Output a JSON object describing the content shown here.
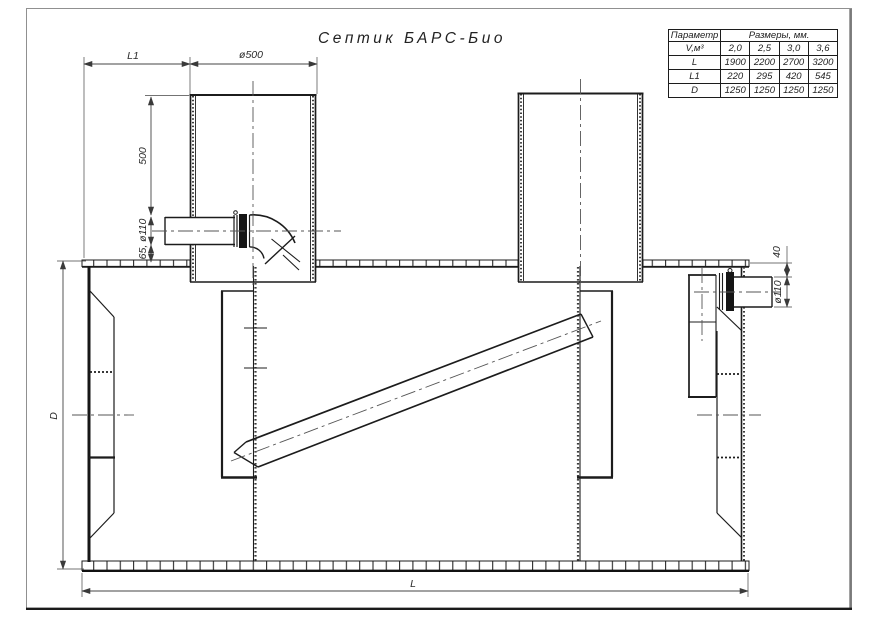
{
  "title": "Септик БАРС-Био",
  "table": {
    "header": {
      "param": "Параметр",
      "sizes": "Размеры, мм."
    },
    "rows": [
      {
        "name": "V,м³",
        "values": [
          "2,0",
          "2,5",
          "3,0",
          "3,6"
        ]
      },
      {
        "name": "L",
        "values": [
          "1900",
          "2200",
          "2700",
          "3200"
        ]
      },
      {
        "name": "L1",
        "values": [
          "220",
          "295",
          "420",
          "545"
        ]
      },
      {
        "name": "D",
        "values": [
          "1250",
          "1250",
          "1250",
          "1250"
        ]
      }
    ]
  },
  "dim_labels": {
    "l1": "L1",
    "dia500": "ø500",
    "h500": "500",
    "inlet": "65, ø110",
    "d": "D",
    "l": "L",
    "offset40": "40",
    "dia110": "ø110"
  },
  "colors": {
    "line": "#1f1f1f",
    "dim": "#444444",
    "fill_dark": "#151515",
    "frame": "#8a8a8a",
    "background": "#ffffff"
  }
}
